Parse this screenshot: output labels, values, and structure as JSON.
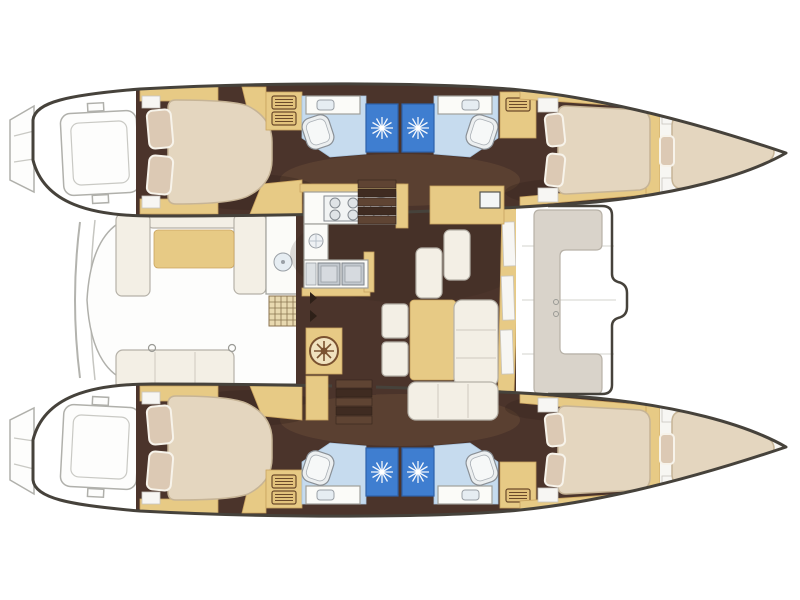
{
  "app": {
    "view": "catamaran-floorplan-top-view",
    "background": "#ffffff"
  },
  "palette": {
    "floor": "#4b342b",
    "floorShade": "#36241c",
    "wash": "#6a4b38",
    "wood": "#e7ca85",
    "woodStroke": "#c9a35f",
    "mattress": "#e4d6bf",
    "mattressStroke": "#c6b496",
    "pillow": "#dcc9b4",
    "pillowEdge": "#f7f3ea",
    "cushion": "#f3efe5",
    "cushionStroke": "#b5b1a8",
    "counter": "#fbfbf8",
    "counterStroke": "#a0a09a",
    "metal": "#c3c9cf",
    "bathFloor": "#c6dbee",
    "showerBlue": "#3f7ed0",
    "showerDeep": "#2d62aa",
    "hullStroke": "#46423b",
    "exStroke": "#b0b0ab",
    "bench": "#d9d3ca",
    "benchStroke": "#b7b1a7",
    "grate": "#e8d9b0",
    "grateStroke": "#8a744f",
    "screen": "#f4f6f6"
  },
  "icons": {
    "shower_drain": "starburst-rays",
    "stove": "four-burner-circles",
    "round_sink": "circle-with-spokes",
    "locker": "slatted-drawer-rect",
    "vent": "waffle-grate",
    "table_inlay": "compass-medallion",
    "toilet": "rounded-square",
    "cleat": "small-ring"
  },
  "rooms_visible_count": {
    "double_cabins": 4,
    "bathrooms_with_shower": 4,
    "forepeak_berths": 2,
    "galley": 1,
    "salon_dinette": 1,
    "aft_cockpit": 1,
    "forward_cockpit": 1
  }
}
